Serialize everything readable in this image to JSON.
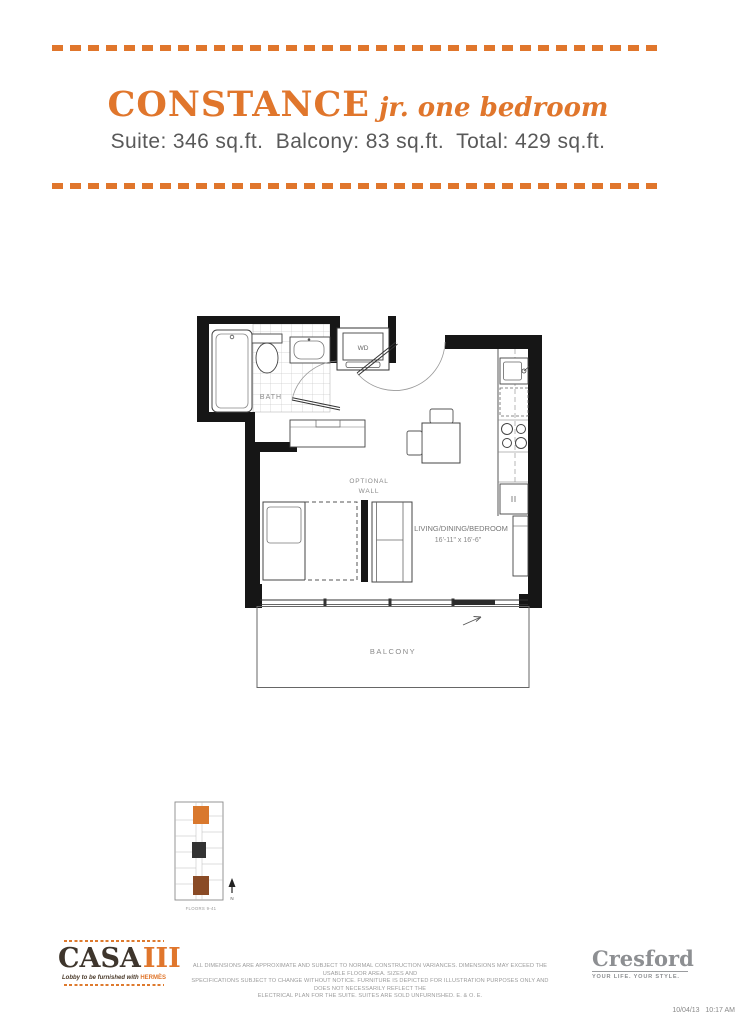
{
  "header": {
    "title": "CONSTANCE",
    "title_suffix": "jr. one bedroom",
    "suite_info": "Suite: 346 sq.ft.  Balcony: 83 sq.ft.  Total: 429 sq.ft."
  },
  "floorplan": {
    "labels": {
      "wd": "WD",
      "bath": "BATH",
      "optional_wall_line1": "OPTIONAL",
      "optional_wall_line2": "WALL",
      "living": "LIVING/DINING/BEDROOM",
      "living_dims": "16'-11\" x 16'-6\"",
      "balcony": "BALCONY"
    }
  },
  "keyplan": {
    "caption": "FLOORS 9-41",
    "north_label": "N",
    "highlight_color": "#d9782d",
    "secondary_color": "#8a4b26"
  },
  "footer": {
    "casa": {
      "name": "CASA",
      "numeral": "III",
      "tagline_prefix": "Lobby to be furnished with",
      "tagline_brand": "HERMÈS"
    },
    "disclaimer": {
      "line1": "ALL DIMENSIONS ARE APPROXIMATE AND SUBJECT TO NORMAL CONSTRUCTION VARIANCES. DIMENSIONS MAY EXCEED THE USABLE FLOOR AREA. SIZES AND",
      "line2": "SPECIFICATIONS SUBJECT TO CHANGE WITHOUT NOTICE. FURNITURE IS DEPICTED FOR ILLUSTRATION PURPOSES ONLY AND DOES NOT NECESSARILY REFLECT THE",
      "line3": "ELECTRICAL PLAN FOR THE SUITE. SUITES ARE SOLD UNFURNISHED. E. & O. E."
    },
    "cresford": {
      "name": "Cresford",
      "tagline": "YOUR LIFE.  YOUR STYLE."
    },
    "timestamp": "10/04/13   10:17 AM"
  },
  "colors": {
    "accent_orange": "#e0762c",
    "text_gray": "#595959",
    "logo_gray": "#8d8f92",
    "wall_black": "#161616"
  }
}
